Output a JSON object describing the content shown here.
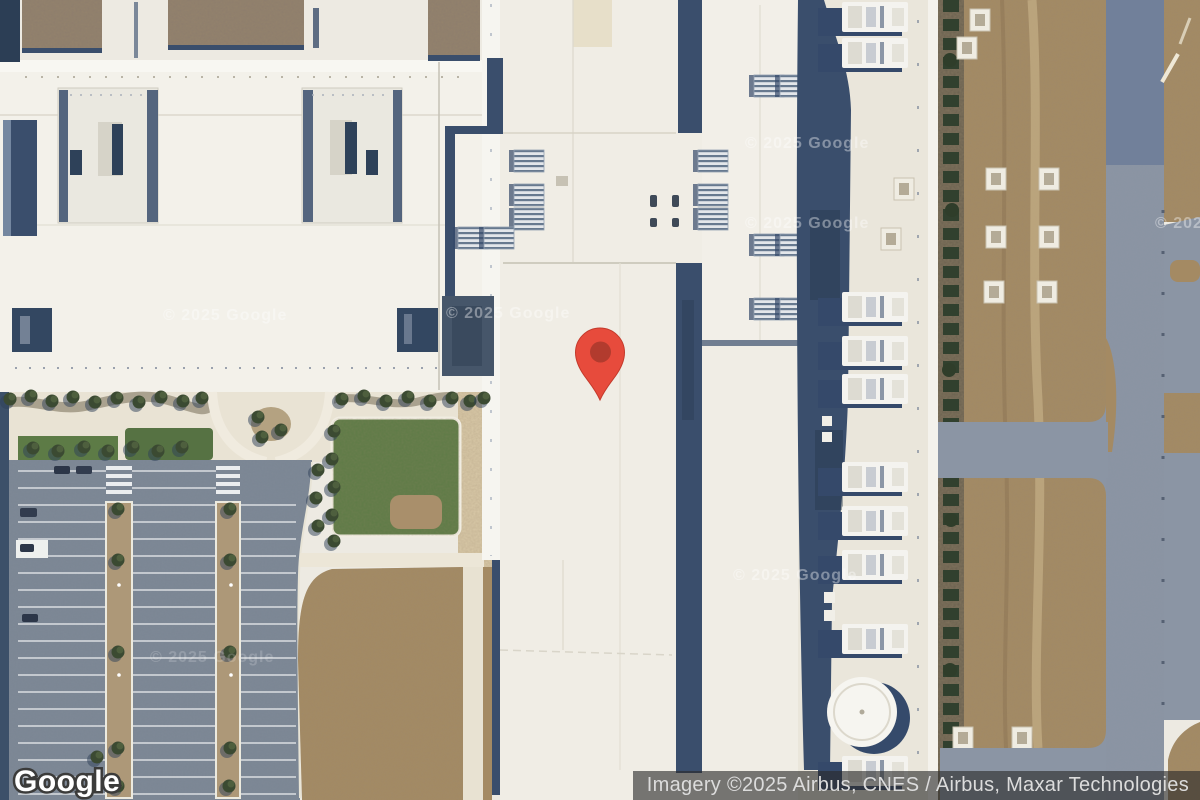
{
  "map": {
    "logo_text": "Google",
    "watermark_text": "© 2025 Google",
    "attribution": "Imagery ©2025 Airbus, CNES / Airbus, Maxar Technologies",
    "marker": {
      "fill": "#E74B3C",
      "stroke": "#C43A2B",
      "dot": "#B23B2E"
    },
    "colors": {
      "attribution_bg": "rgba(42,42,42,0.62)",
      "attribution_text": "#DCDCDC",
      "roof_white": "#F0EDE5",
      "shadow_navy": "#3A4E6C",
      "dirt": "#A48A63",
      "road": "#8B95A4",
      "grass": "#5D7B46"
    }
  }
}
